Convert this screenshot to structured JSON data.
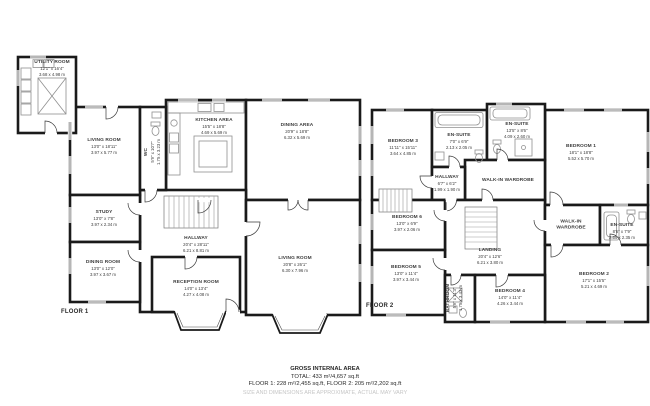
{
  "colors": {
    "wall": "#1a1a1a",
    "fixture": "#909090",
    "label_text": "#3c3c3c",
    "footer_text": "#2a2a2a",
    "disclaimer_text": "#c6c6c6",
    "background": "#ffffff"
  },
  "floor1": {
    "label": "FLOOR 1",
    "rooms": {
      "utility": {
        "name": "UTILITY ROOM",
        "imperial": "12'1\" x 16'4\"",
        "metric": "3.68 x 4.98 m"
      },
      "living_room": {
        "name": "LIVING ROOM",
        "imperial": "13'0\" x 18'11\"",
        "metric": "3.97 x 5.77 m"
      },
      "study": {
        "name": "STUDY",
        "imperial": "13'0\" x 7'8\"",
        "metric": "3.97 x 2.34 m"
      },
      "dining_room": {
        "name": "DINING ROOM",
        "imperial": "13'0\" x 12'0\"",
        "metric": "3.97 x 3.67 m"
      },
      "wc": {
        "name": "WC",
        "imperial": "5'9\" x 10'7\"",
        "metric": "1.75 x 3.23 m"
      },
      "kitchen_area": {
        "name": "KITCHEN AREA",
        "imperial": "15'5\" x 18'8\"",
        "metric": "4.69 x 5.69 m"
      },
      "dining_area": {
        "name": "DINING AREA",
        "imperial": "20'9\" x 18'8\"",
        "metric": "6.32 x 5.69 m"
      },
      "hallway": {
        "name": "HALLWAY",
        "imperial": "20'4\" x 28'11\"",
        "metric": "6.21 x 8.81 m"
      },
      "reception_room": {
        "name": "RECEPTION ROOM",
        "imperial": "14'0\" x 13'4\"",
        "metric": "4.27 x 4.08 m"
      },
      "living_room_2": {
        "name": "LIVING ROOM",
        "imperial": "20'8\" x 26'1\"",
        "metric": "6.30 x 7.96 m"
      }
    }
  },
  "floor2": {
    "label": "FLOOR 2",
    "rooms": {
      "bedroom_3": {
        "name": "BEDROOM 3",
        "imperial": "11'11\" x 15'11\"",
        "metric": "3.64 x 4.85 m"
      },
      "en_suite_1": {
        "name": "EN-SUITE",
        "imperial": "7'0\" x 6'9\"",
        "metric": "2.13 x 2.05 m"
      },
      "en_suite_2": {
        "name": "EN-SUITE",
        "imperial": "13'5\" x 8'6\"",
        "metric": "4.09 x 2.60 m"
      },
      "bedroom_1": {
        "name": "BEDROOM 1",
        "imperial": "18'1\" x 18'8\"",
        "metric": "5.52 x 5.70 m"
      },
      "hallway": {
        "name": "HALLWAY",
        "imperial": "6'7\" x 6'2\"",
        "metric": "1.99 x 1.90 m"
      },
      "walk_in_wardrobe_1": {
        "name": "WALK-IN WARDROBE"
      },
      "bedroom_6": {
        "name": "BEDROOM 6",
        "imperial": "13'0\" x 6'9\"",
        "metric": "3.97 x 2.06 m"
      },
      "landing": {
        "name": "LANDING",
        "imperial": "20'4\" x 12'6\"",
        "metric": "6.21 x 3.80 m"
      },
      "bedroom_5": {
        "name": "BEDROOM 5",
        "imperial": "13'0\" x 11'4\"",
        "metric": "3.97 x 3.44 m"
      },
      "bathroom": {
        "name": "BATHROOM",
        "imperial": "5'9\" x 11'3\"",
        "metric": "1.75 x 3.43 m"
      },
      "bedroom_4": {
        "name": "BEDROOM 4",
        "imperial": "14'0\" x 11'4\"",
        "metric": "4.26 x 3.44 m"
      },
      "walk_in_wardrobe_2": {
        "name": "WALK-IN WARDROBE"
      },
      "en_suite_3": {
        "name": "EN-SUITE",
        "imperial": "8'6\" x 7'9\"",
        "metric": "2.59 x 2.35 m"
      },
      "bedroom_2": {
        "name": "BEDROOM 2",
        "imperial": "17'1\" x 15'5\"",
        "metric": "5.21 x 4.69 m"
      }
    }
  },
  "footer": {
    "title": "GROSS INTERNAL AREA",
    "total": "TOTAL: 433 m²/4,657 sq.ft",
    "floor_breakdown": "FLOOR 1: 228 m²/2,455 sq.ft, FLOOR 2: 205 m²/2,202 sq.ft",
    "disclaimer": "SIZE AND DIMENSIONS ARE APPROXIMATE, ACTUAL MAY VARY"
  }
}
